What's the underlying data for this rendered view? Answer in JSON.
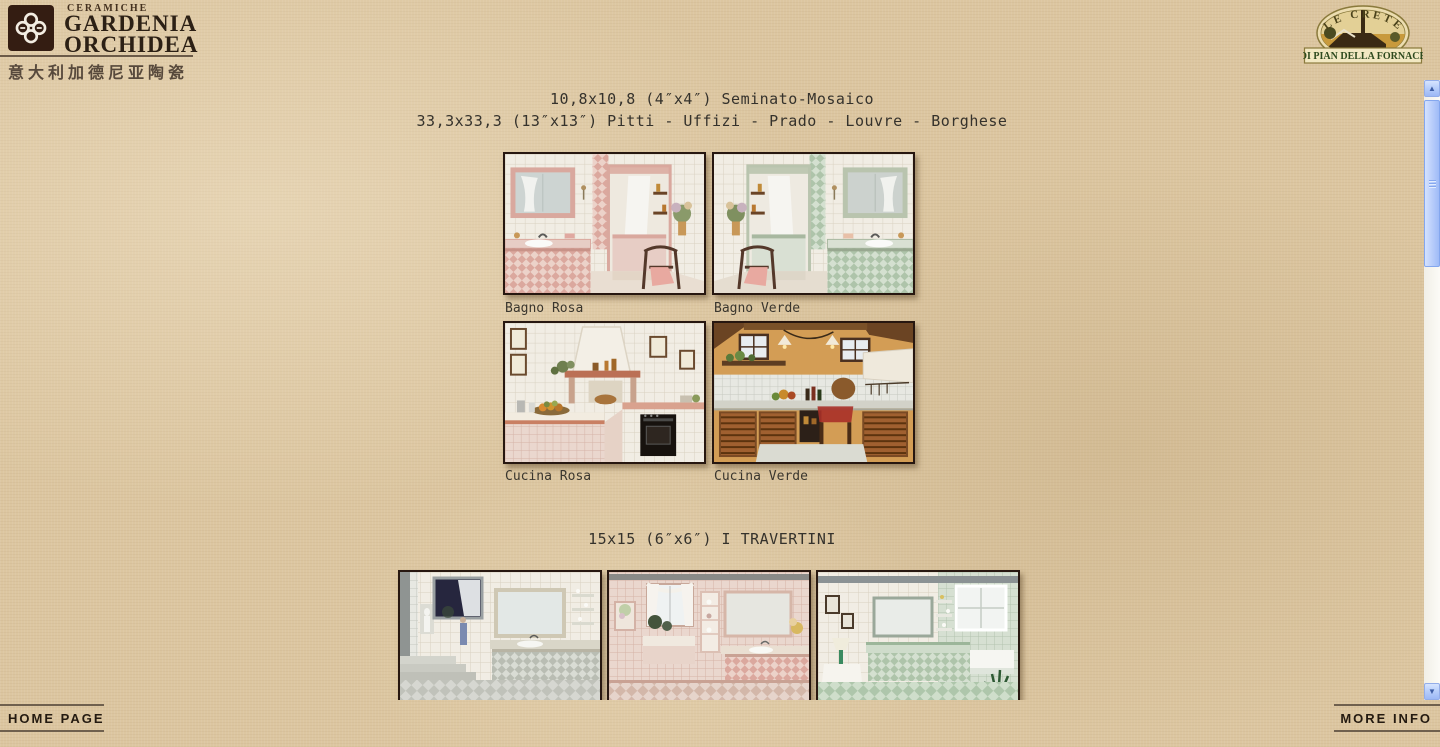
{
  "header": {
    "brand": {
      "ceramiche": "CERAMICHE",
      "name_line1": "GARDENIA",
      "name_line2": "ORCHIDEA",
      "chinese_tagline": "意大利加德尼亚陶瓷"
    },
    "crete_badge": {
      "top_arc": "LE CRETE",
      "banner": "DI PIAN DELLA FORNACE"
    }
  },
  "content": {
    "mosaico_section": {
      "heading_line1": "10,8x10,8 (4″x4″) Seminato-Mosaico",
      "heading_line2": "33,3x33,3 (13″x13″) Pitti - Uffizi - Prado - Louvre - Borghese",
      "photos": [
        {
          "caption": "Bagno Rosa"
        },
        {
          "caption": "Bagno Verde"
        },
        {
          "caption": "Cucina Rosa"
        },
        {
          "caption": "Cucina Verde"
        }
      ]
    },
    "travertini_section": {
      "heading": "15x15 (6″x6″) I TRAVERTINI"
    }
  },
  "footer": {
    "home_link": "HOME PAGE",
    "more_link": "MORE INFO"
  },
  "icons": {
    "scroll_up": "▲",
    "scroll_down": "▼"
  },
  "colors": {
    "page_background": "#dcc6a0",
    "heading_text": "#35322c",
    "brand_dark": "#2c2015",
    "logo_square": "#341d12",
    "footer_text": "#241a10",
    "footer_rule": "#6f604e",
    "scrollbar_thumb": "#b4cafa",
    "photo_border": "#271710"
  }
}
